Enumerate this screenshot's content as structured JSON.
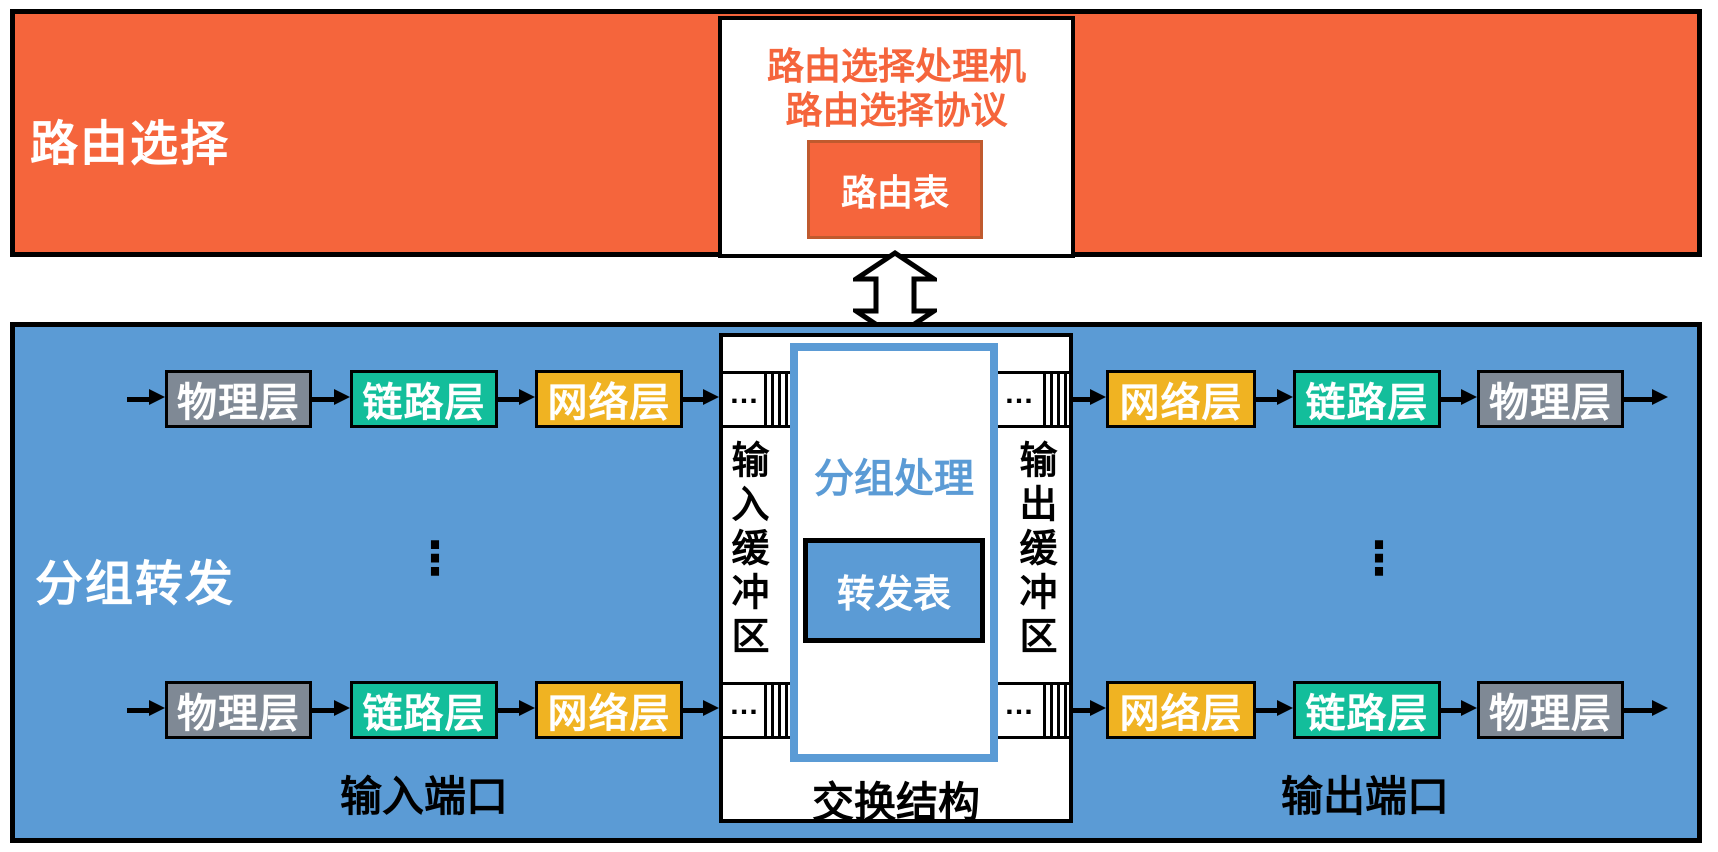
{
  "colors": {
    "orange": "#F5653C",
    "blue": "#5B9BD5",
    "gray_layer": "#7F8995",
    "green_layer": "#13BE9B",
    "yellow_layer": "#F0B322",
    "routing_table_border": "#C05A2E",
    "outline": "#000000"
  },
  "routing_section": {
    "label": "路由选择",
    "processor_line1": "路由选择处理机",
    "processor_line2": "路由选择协议",
    "routing_table": "路由表"
  },
  "forwarding_section": {
    "label": "分组转发",
    "input_port_label": "输入端口",
    "output_port_label": "输出端口",
    "switch_fabric_label": "交换结构",
    "input_buffer_label": "输入缓冲区",
    "output_buffer_label": "输出缓冲区",
    "packet_processing_label": "分组处理",
    "forwarding_table_label": "转发表",
    "queue_ellipsis": "…",
    "rows_ellipsis": "⋮"
  },
  "layers": {
    "physical": "物理层",
    "link": "链路层",
    "network": "网络层"
  }
}
